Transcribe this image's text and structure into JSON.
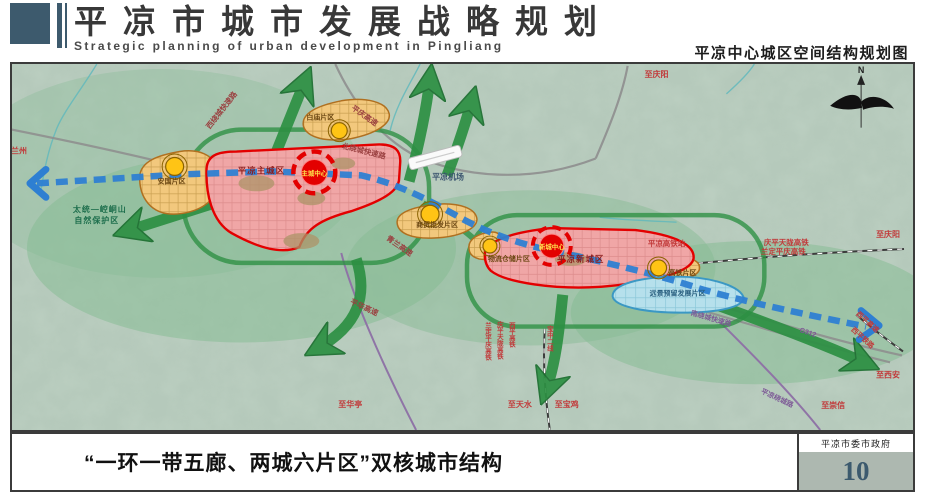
{
  "header": {
    "title": "平凉市城市发展战略规划",
    "subtitle_en": "Strategic planning of urban development in Pingliang",
    "map_caption": "平凉中心城区空间结构规划图"
  },
  "footer": {
    "caption": "“一环一带五廊、两城六片区”双核城市结构",
    "agency": "平凉市委市政府",
    "page_number": "10"
  },
  "map": {
    "compass_label": "N",
    "cities": {
      "main_city": "平凉主城区",
      "new_city": "平凉新城区",
      "main_center": "主城中心",
      "new_center": "新城中心"
    },
    "districts": {
      "anguo": "安国片区",
      "baimiao": "白庙片区",
      "shangmao": "商贸批发片区",
      "wuliu": "物流仓储片区",
      "gaotie": "高铁片区",
      "yuanjing": "远景预留发展片区"
    },
    "features": {
      "airport": "平凉机场",
      "hsr_station": "平凉高铁站",
      "nature_reserve_line1": "太统—崆峒山",
      "nature_reserve_line2": "自然保护区"
    },
    "roads": {
      "west_ring": "西绕城快速路",
      "north_ring": "北绕城快速路",
      "south_ring": "南绕城快速路",
      "pingqing_expwy": "平庆高速",
      "qinglan_expwy": "青兰高速",
      "pinghua_expwy": "平华高速",
      "g312": "G312",
      "xiping_expwy": "西平高速",
      "xiping_railway": "西平铁路",
      "pl_ring_road": "平凉绕城路"
    },
    "railways": {
      "hsr_line1": "庆平天陇高铁",
      "hsr_line2": "兰定平庆高铁",
      "v_lanping": "兰定平庆高铁",
      "v_qingping": "庆平天陇高铁",
      "v_xiping": "西平高铁",
      "baozhong2": "宝中二线"
    },
    "directions": {
      "to_lanzhou": "至兰州",
      "to_qingyang_top": "至庆阳",
      "to_qingyang_right": "至庆阳",
      "to_xian": "至西安",
      "to_chongxin": "至崇信",
      "to_huating": "至华亭",
      "to_tianshui": "至天水",
      "to_baoji": "至宝鸡"
    }
  },
  "colors": {
    "accent_slate": "#3d5a6d",
    "city_red": "#e30000",
    "district_orange": "#e8a94e",
    "corridor_green": "#2d9043",
    "axis_blue": "#2e7fd2",
    "reserve_blue": "#59b8d8",
    "page_number_bg": "#adb8b0"
  }
}
